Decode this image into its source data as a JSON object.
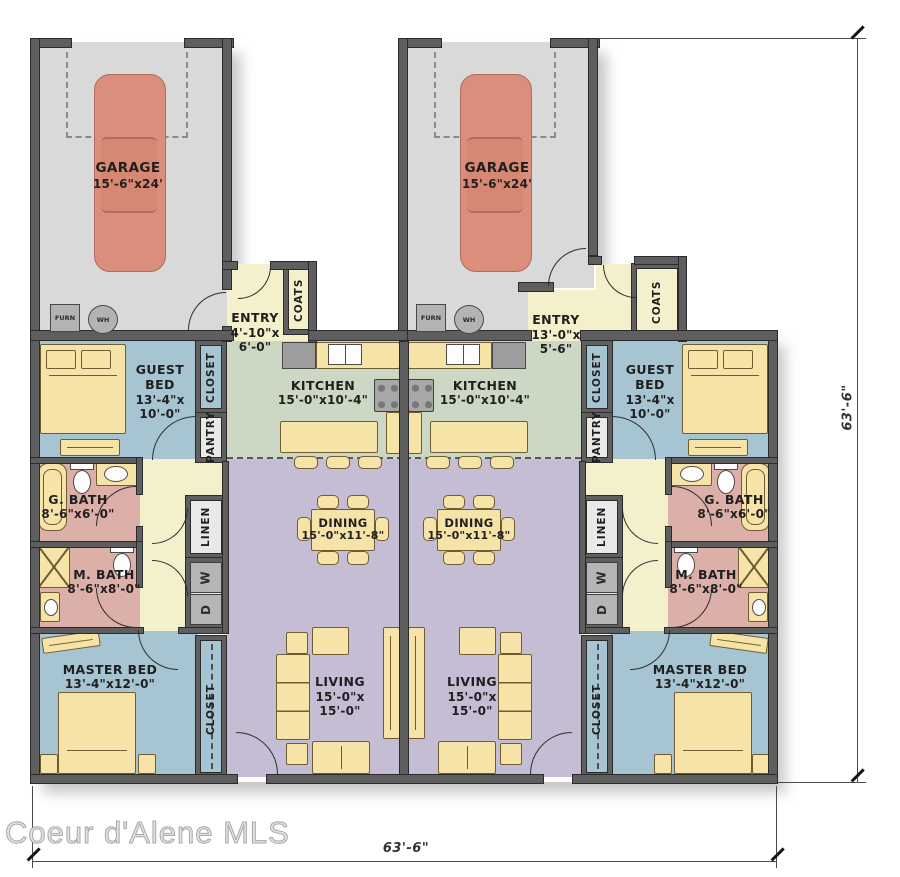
{
  "watermark": "Coeur d'Alene MLS",
  "dimensions": {
    "bottom": "63'-6\"",
    "right": "63'-6\""
  },
  "labels": {
    "garage": {
      "name": "GARAGE",
      "size": "15'-6\"x24'"
    },
    "entry_left": {
      "name": "ENTRY",
      "size1": "4'-10\"x",
      "size2": "6'-0\""
    },
    "entry_right": {
      "name": "ENTRY",
      "size1": "13'-0\"x",
      "size2": "5'-6\""
    },
    "kitchen": {
      "name": "KITCHEN",
      "size": "15'-0\"x10'-4\""
    },
    "guest_bed": {
      "name1": "GUEST",
      "name2": "BED",
      "size1": "13'-4\"x",
      "size2": "10'-0\""
    },
    "g_bath": {
      "name": "G. BATH",
      "size": "8'-6\"x6'-0\""
    },
    "m_bath": {
      "name": "M. BATH",
      "size": "8'-6\"x8'-0\""
    },
    "master_bed": {
      "name": "MASTER BED",
      "size": "13'-4\"x12'-0\""
    },
    "dining": {
      "name": "DINING",
      "size": "15'-0\"x11'-8\""
    },
    "living": {
      "name": "LIVING",
      "size1": "15'-0\"x",
      "size2": "15'-0\""
    },
    "closet": "CLOSET",
    "pantry": "PANTRY",
    "linen": "LINEN",
    "coats": "COATS",
    "furn": "FURN",
    "wh": "WH",
    "washer": "W",
    "dryer": "D"
  },
  "colors": {
    "wall": "#5e5e5e",
    "garage_floor": "#d9d9d9",
    "kitchen_floor": "#ccd8c3",
    "hall_floor": "#f4f0cc",
    "living_floor": "#c5bdd3",
    "bedroom_floor": "#a7c4d3",
    "bath_floor": "#dcafa9",
    "furniture": "#f6e3a8",
    "car": "#dc8e7c"
  }
}
